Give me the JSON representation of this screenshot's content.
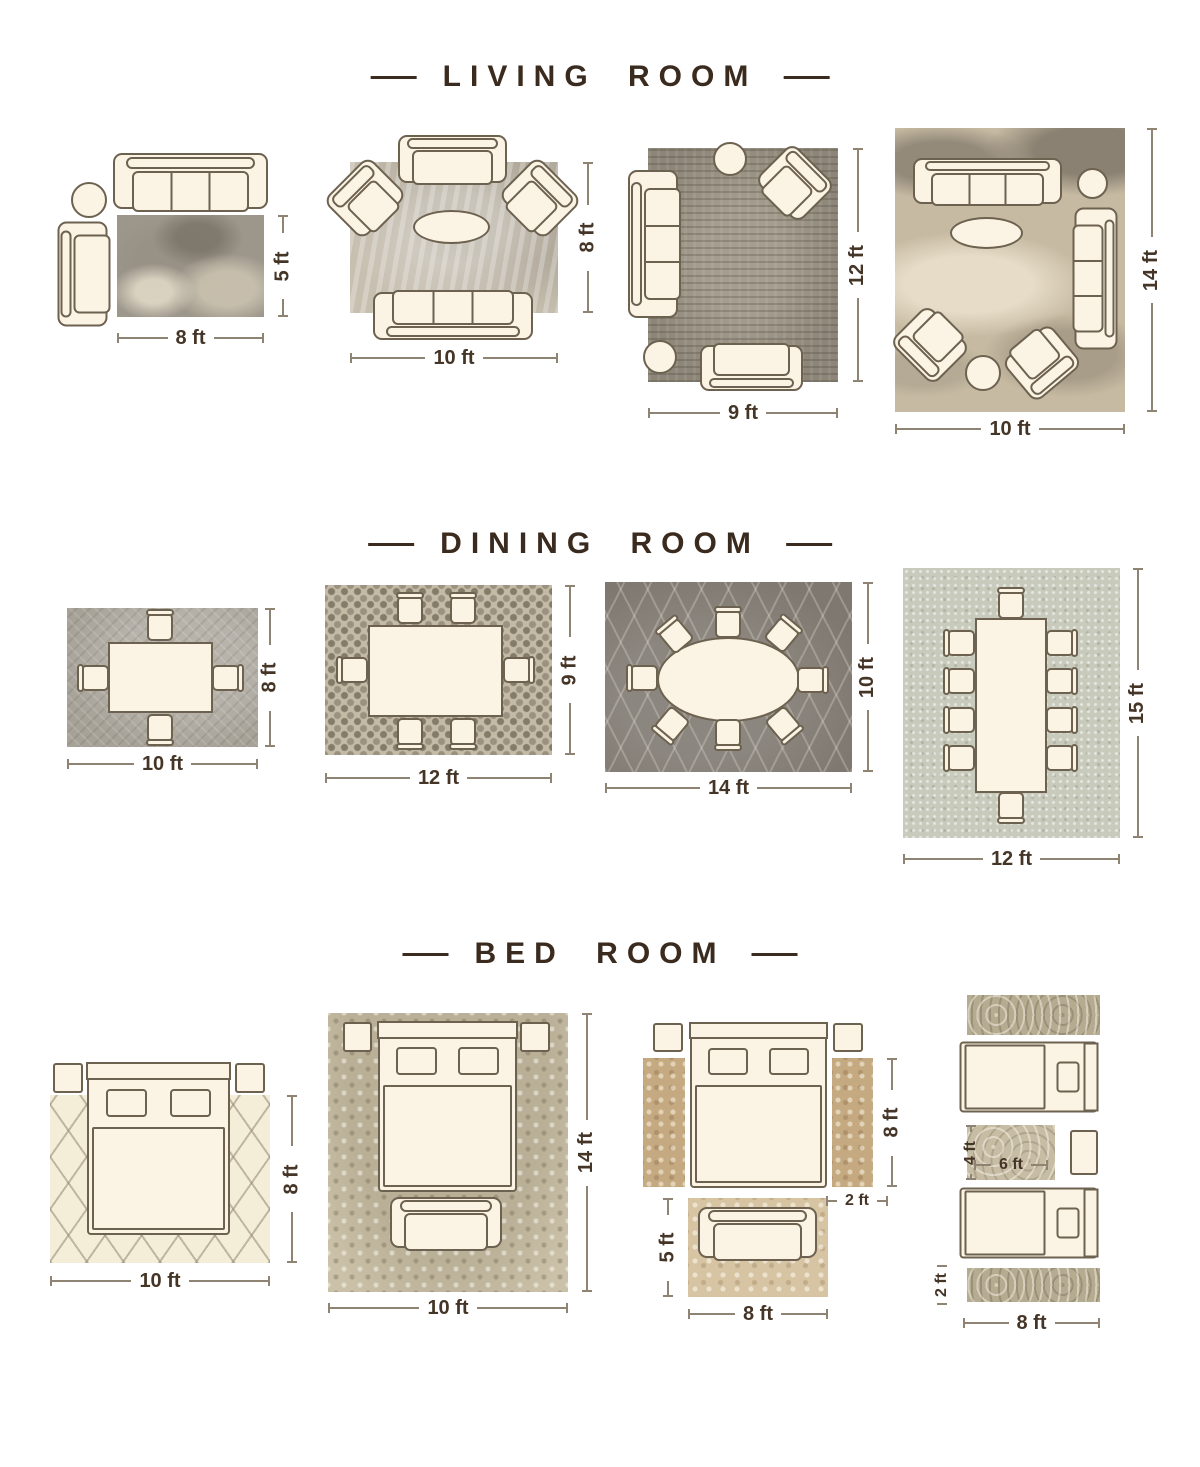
{
  "colors": {
    "bg": "#ffffff",
    "title": "#3a2b1e",
    "dim-text": "#453527",
    "dim-line": "#8f8373",
    "furn-fill": "#fbf3e3",
    "furn-line": "#6d6150"
  },
  "sections": {
    "living": {
      "title": "LIVING ROOM",
      "layouts": {
        "l1": {
          "width": "8 ft",
          "height": "5 ft"
        },
        "l2": {
          "width": "10 ft",
          "height": "8 ft"
        },
        "l3": {
          "width": "9 ft",
          "height": "12 ft"
        },
        "l4": {
          "width": "10 ft",
          "height": "14 ft"
        }
      }
    },
    "dining": {
      "title": "DINING ROOM",
      "layouts": {
        "l1": {
          "width": "10 ft",
          "height": "8 ft"
        },
        "l2": {
          "width": "12 ft",
          "height": "9 ft"
        },
        "l3": {
          "width": "14 ft",
          "height": "10 ft"
        },
        "l4": {
          "width": "12 ft",
          "height": "15 ft"
        }
      }
    },
    "bed": {
      "title": "BED ROOM",
      "layouts": {
        "l1": {
          "width": "10 ft",
          "height": "8 ft"
        },
        "l2": {
          "width": "10 ft",
          "height": "14 ft"
        },
        "l3": {
          "runner_height": "8 ft",
          "runner_width": "2 ft",
          "foot_rug_height": "5 ft",
          "foot_rug_width": "8 ft"
        },
        "l4": {
          "mat_height": "4 ft",
          "mat_width": "6 ft",
          "runner_height": "2 ft",
          "runner_width": "8 ft"
        }
      }
    }
  }
}
